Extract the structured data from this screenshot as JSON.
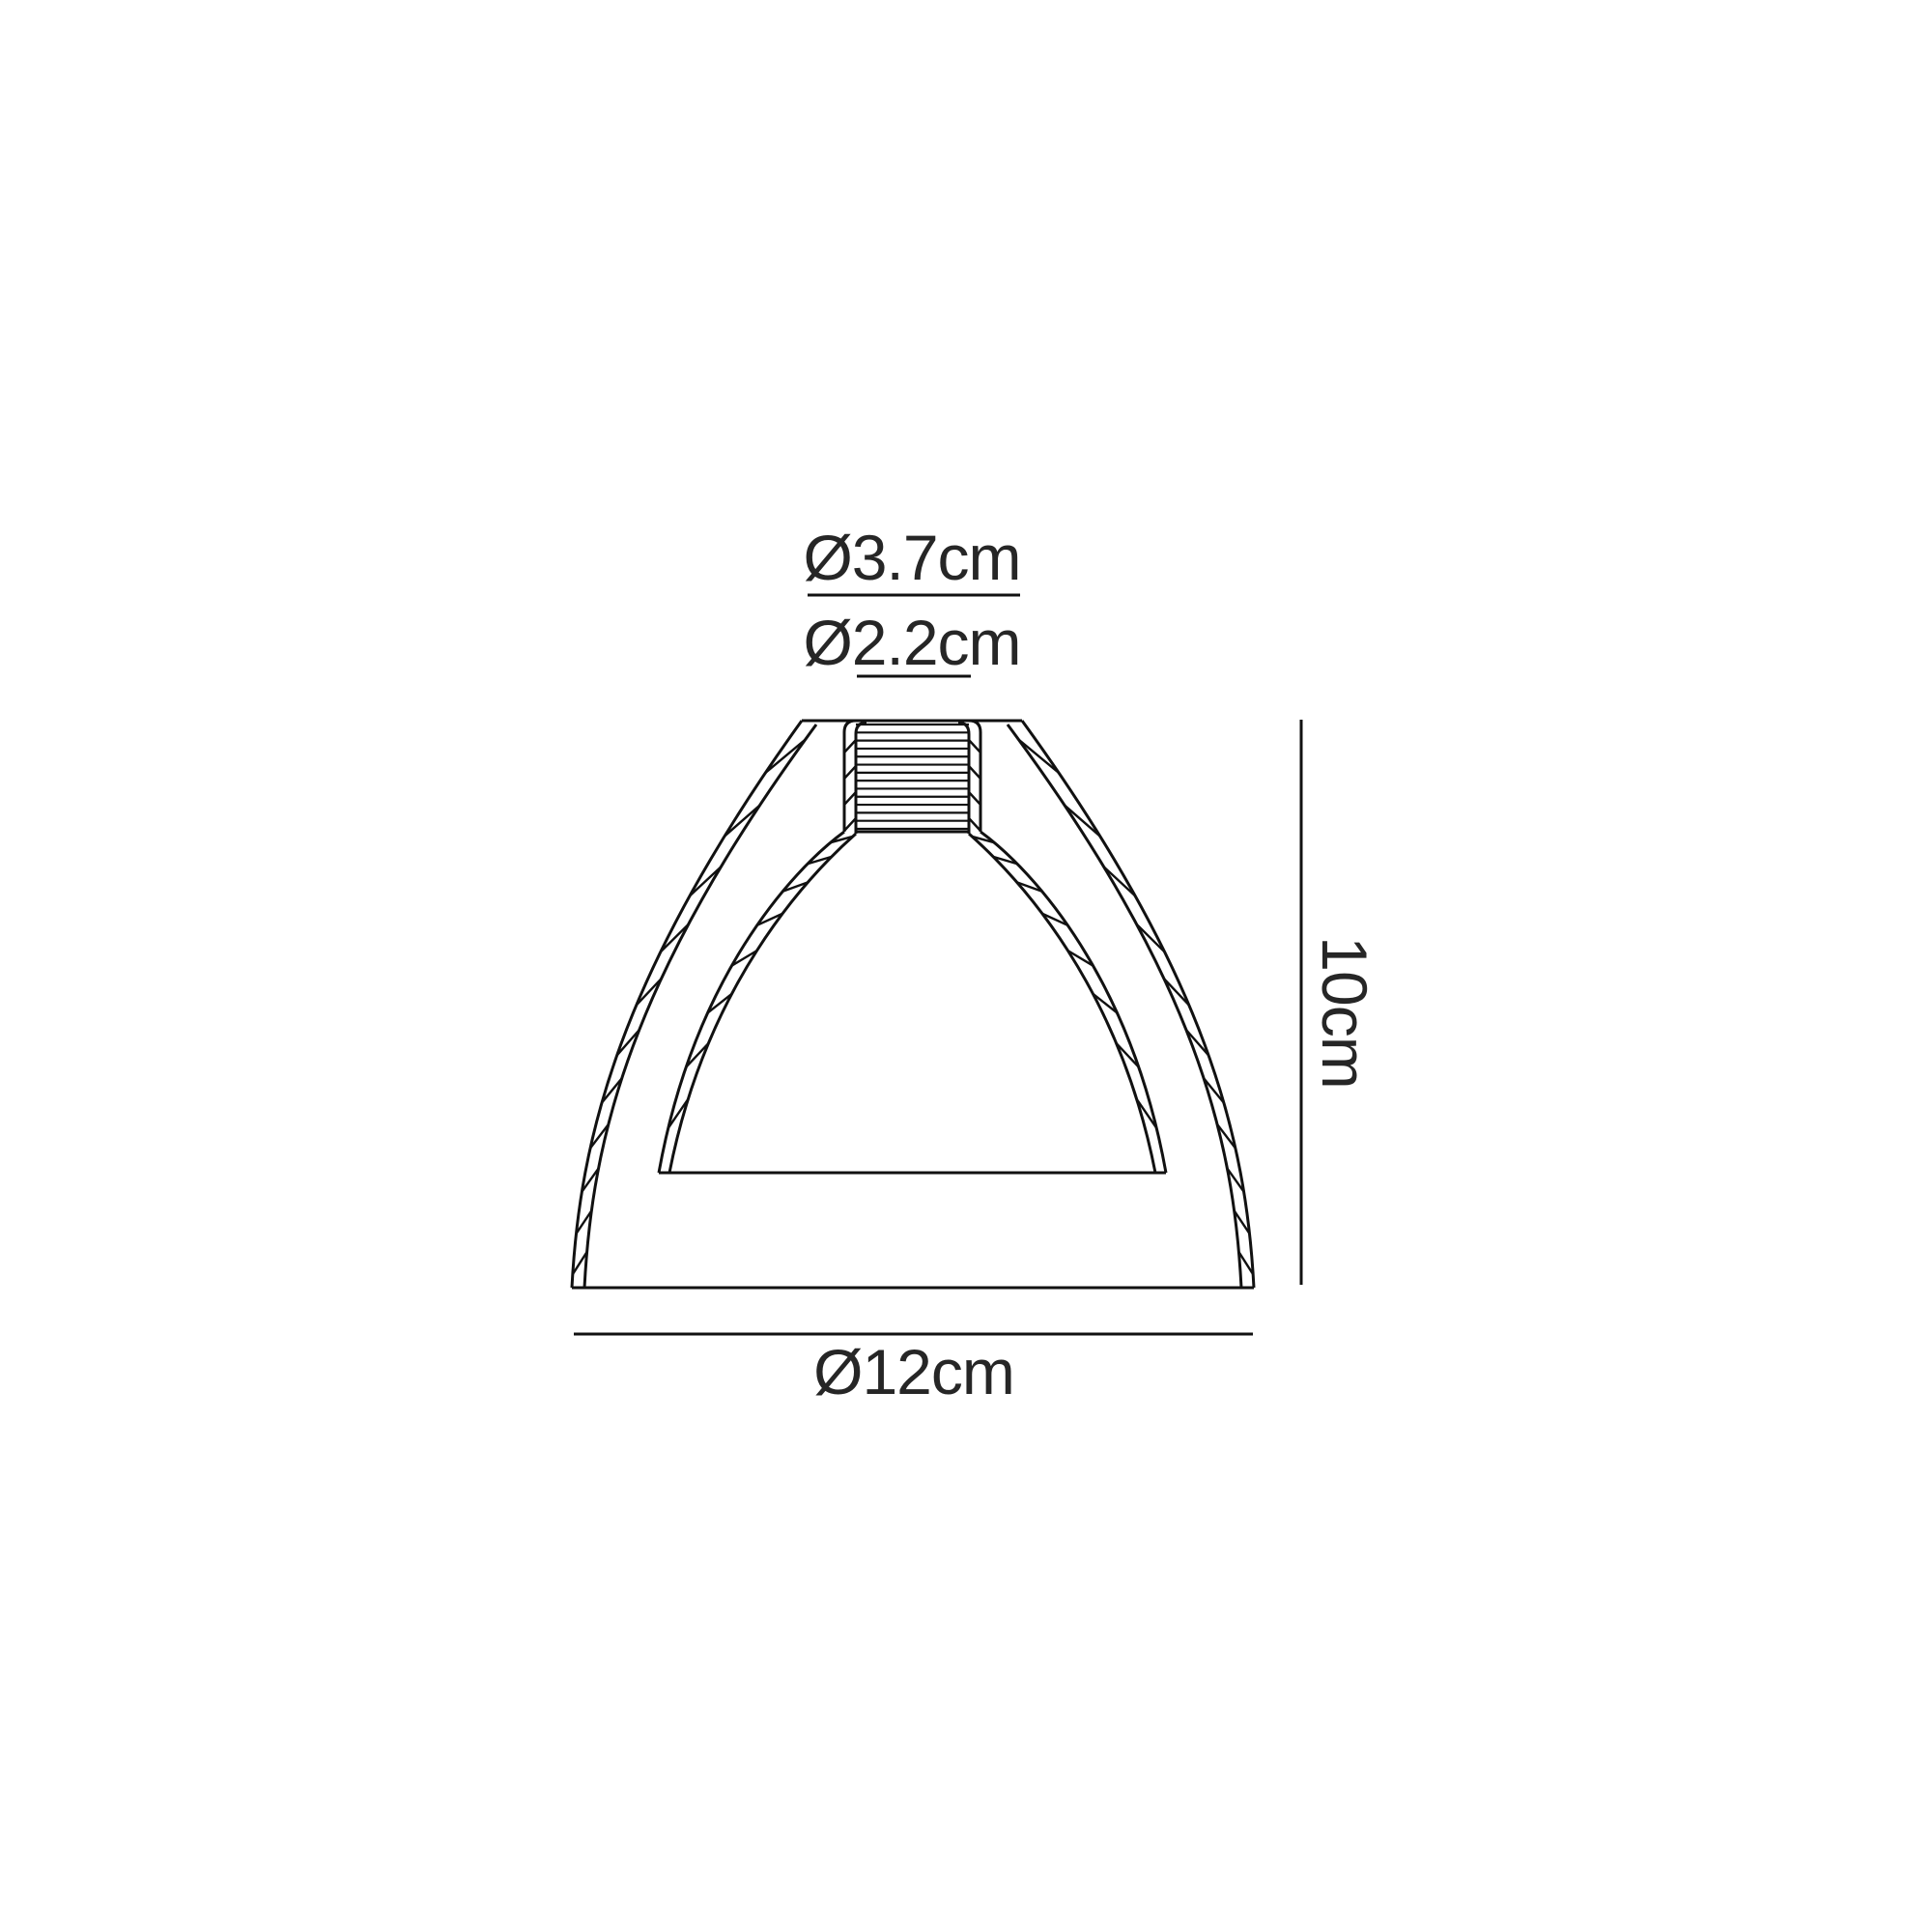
{
  "labels": {
    "top_diameter": "Ø3.7cm",
    "neck_diameter": "Ø2.2cm",
    "height": "10cm",
    "bottom_diameter": "Ø12cm"
  },
  "colors": {
    "line": "#111111",
    "text": "#262626",
    "background": "#ffffff"
  }
}
